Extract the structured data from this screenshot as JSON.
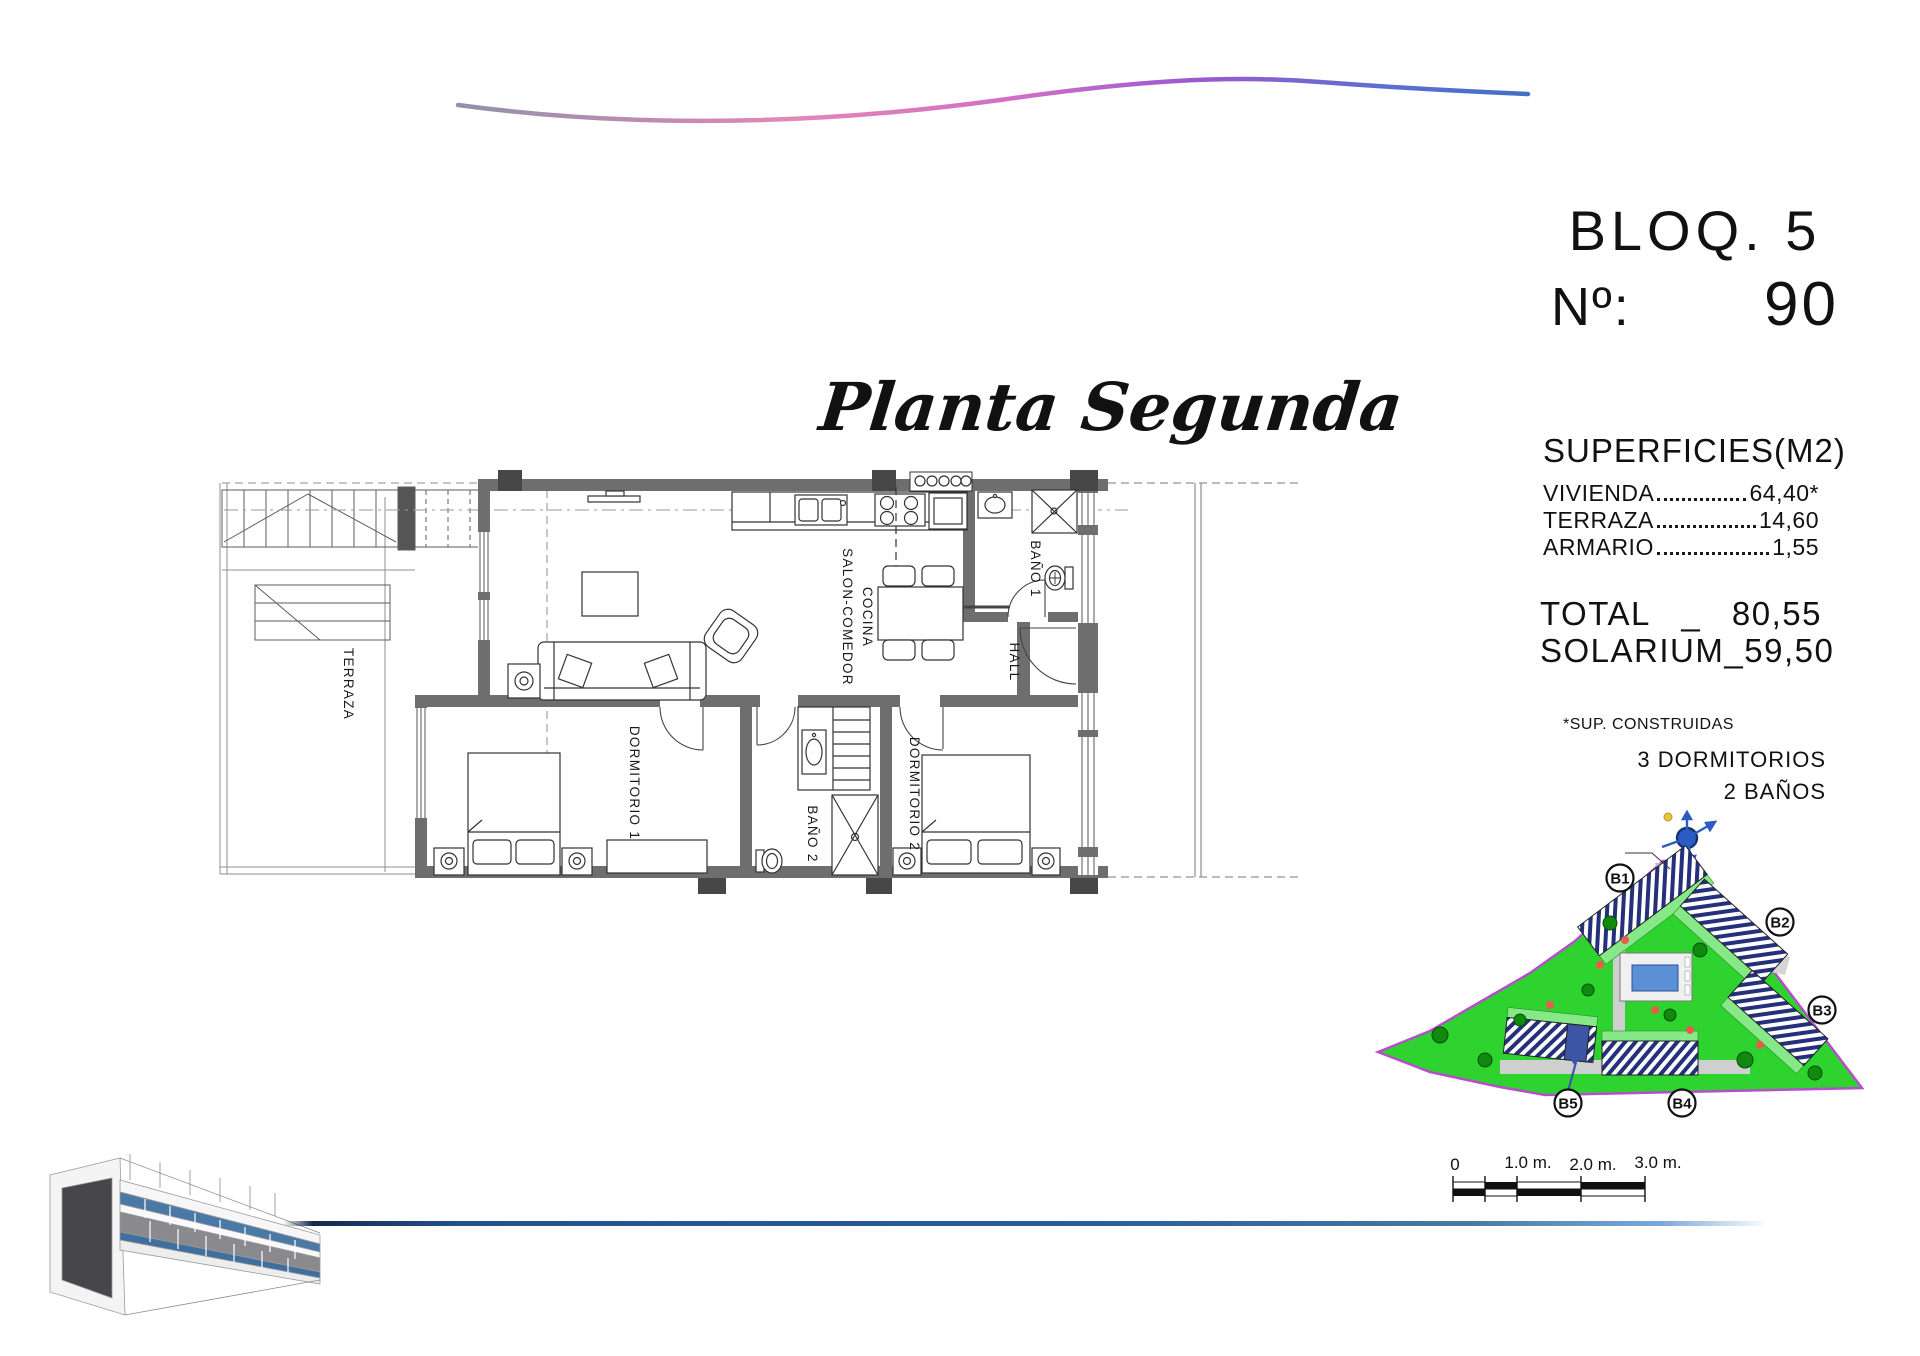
{
  "header": {
    "block_label": "BLOQ. 5",
    "number_label": "Nº:",
    "number_value": "90"
  },
  "plan": {
    "title": "Planta Segunda",
    "rooms": {
      "terraza": "TERRAZA",
      "salon_line1": "SALON-COMEDOR",
      "salon_line2": "COCINA",
      "bano1": "BAÑO 1",
      "hall": "HALL",
      "dormitorio1": "DORMITORIO 1",
      "bano2": "BAÑO 2",
      "dormitorio2": "DORMITORIO 2"
    }
  },
  "surfaces": {
    "title": "SUPERFICIES(M2)",
    "rows": [
      {
        "label": "VIVIENDA",
        "value": "64,40*"
      },
      {
        "label": "TERRAZA",
        "value": "14,60"
      },
      {
        "label": "ARMARIO",
        "value": "1,55"
      }
    ],
    "total_label": "TOTAL",
    "total_sep": "_",
    "total_value": "80,55",
    "solarium_label": "SOLARIUM",
    "solarium_sep": "_",
    "solarium_value": "59,50",
    "footnote": "*SUP. CONSTRUIDAS",
    "bedrooms": "3 DORMITORIOS",
    "bathrooms": "2 BAÑOS"
  },
  "site_plan": {
    "blocks": [
      "B1",
      "B2",
      "B3",
      "B4",
      "B5"
    ]
  },
  "scale_bar": {
    "labels": [
      "0",
      "1.0 m.",
      "2.0 m.",
      "3.0 m."
    ]
  },
  "colors": {
    "wave_gradient": [
      "#8b93a6",
      "#e387b8",
      "#b75fcf",
      "#3f6fc5"
    ],
    "site_green": "#2fd32f",
    "boundary_purple": "#b44fc9",
    "hatch_navy": "#24307a",
    "pool_blue": "#5b8fd6",
    "highlight_blue": "#3c55a5",
    "wall_gray": "#6e6e6e",
    "line_blue": "#2c5d99"
  }
}
